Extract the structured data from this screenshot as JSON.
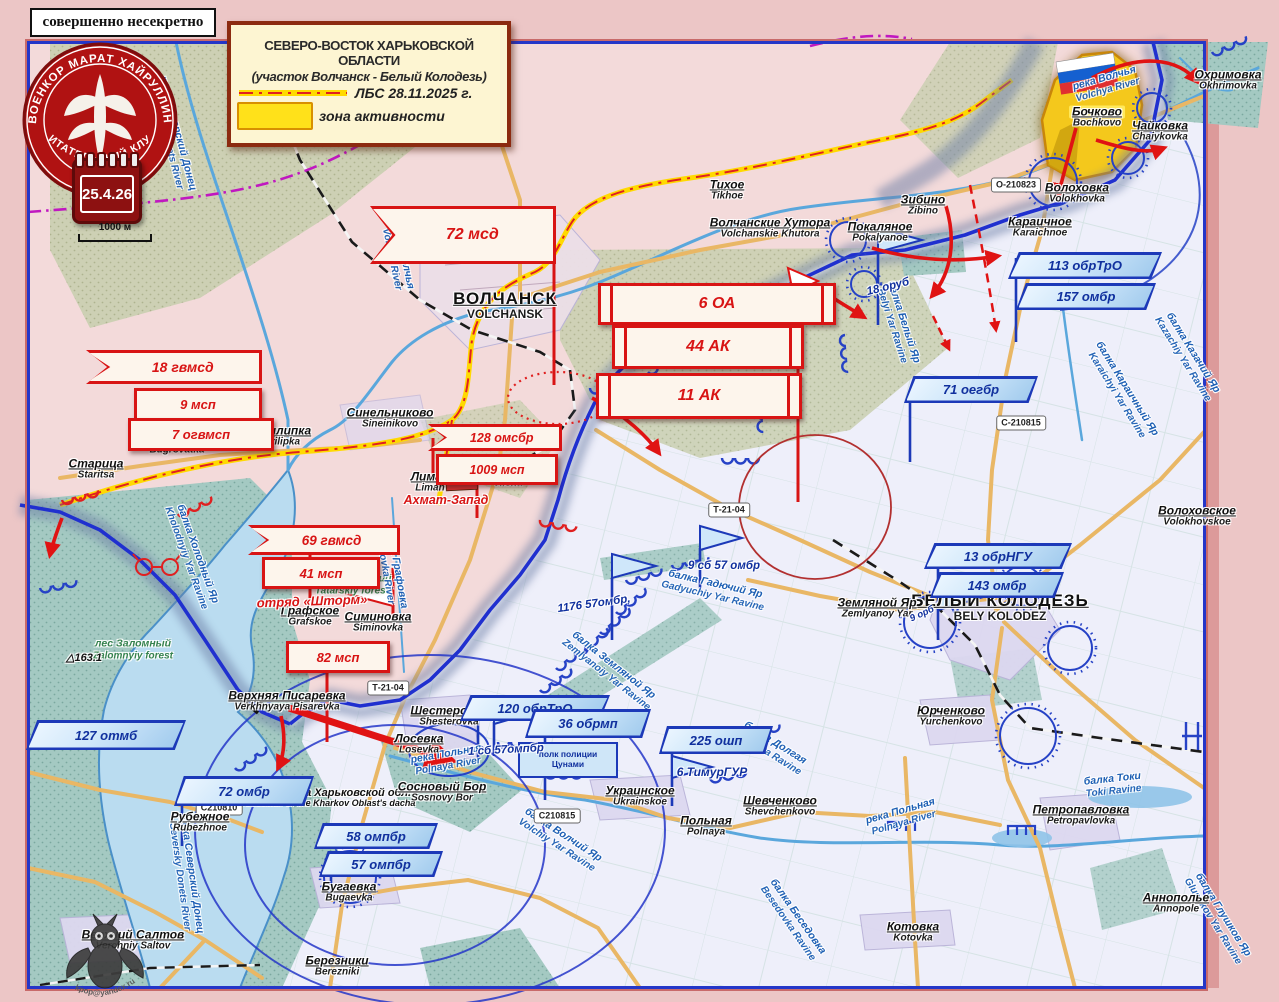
{
  "frame": {
    "stamp": "совершенно несекретно",
    "date": "25.4.26",
    "scale": "1000 м"
  },
  "logo": {
    "top": "ВОЕНКОР МАРАТ ХАЙРУЛЛИН",
    "bottom": "ЧИТАТЕЛЬСКИЙ КЛУБ"
  },
  "watermark": "kpop@yandex.ru",
  "title_box": {
    "line1": "СЕВЕРО-ВОСТОК ХАРЬКОВСКОЙ ОБЛАСТИ",
    "line2": "(участок  Волчанск - Белый Колодезь)",
    "lbs": "ЛБС  28.11.2025 г.",
    "zone": "зона активности"
  },
  "colors": {
    "red_units": "#d81414",
    "blue_units": "#1c39b8",
    "front_line": "#2030cf",
    "lbs_yellow": "#ffd900",
    "zone_yellow": "#f5c81a"
  },
  "settlements": [
    {
      "ru": "ВОЛЧАНСК",
      "en": "VOLCHANSK",
      "x": 505,
      "y": 305,
      "big": true
    },
    {
      "ru": "БЕЛЫЙ КОЛОДЕЗЬ",
      "en": "BELY KOLODEZ",
      "x": 1000,
      "y": 607,
      "big": true
    },
    {
      "ru": "Тихое",
      "en": "Tikhoe",
      "x": 727,
      "y": 190
    },
    {
      "ru": "Волчанские Хутора",
      "en": "Volchanskie Khutora",
      "x": 770,
      "y": 228
    },
    {
      "ru": "Зибино",
      "en": "Zibino",
      "x": 923,
      "y": 205
    },
    {
      "ru": "Покаляное",
      "en": "Pokalyanoe",
      "x": 880,
      "y": 232
    },
    {
      "ru": "Бочково",
      "en": "Bochkovo",
      "x": 1097,
      "y": 117,
      "hl": true
    },
    {
      "ru": "Чайковка",
      "en": "Chaiykovka",
      "x": 1160,
      "y": 131
    },
    {
      "ru": "Охримовка",
      "en": "Okhrimovka",
      "x": 1228,
      "y": 80
    },
    {
      "ru": "Волоховка",
      "en": "Volokhovka",
      "x": 1077,
      "y": 193
    },
    {
      "ru": "Караичное",
      "en": "Karaichnoe",
      "x": 1040,
      "y": 227
    },
    {
      "ru": "Волоховское",
      "en": "Volokhovskoe",
      "x": 1197,
      "y": 516
    },
    {
      "ru": "Синельниково",
      "en": "Sineinikovo",
      "x": 390,
      "y": 418
    },
    {
      "ru": "Прилипка",
      "en": "Prilipka",
      "x": 282,
      "y": 436
    },
    {
      "ru": "Бугроватка",
      "en": "Bugrovatka",
      "x": 177,
      "y": 444
    },
    {
      "ru": "Старица",
      "en": "Staritsa",
      "x": 96,
      "y": 469
    },
    {
      "ru": "Вильча",
      "en": "Vilcha",
      "x": 508,
      "y": 477
    },
    {
      "ru": "Лиман",
      "en": "Liman",
      "x": 430,
      "y": 482
    },
    {
      "ru": "Графское",
      "en": "Grafskoe",
      "x": 310,
      "y": 616
    },
    {
      "ru": "Симиновка",
      "en": "Siminovka",
      "x": 378,
      "y": 622
    },
    {
      "ru": "Верхняя Писаревка",
      "en": "Verkhnyaya  Pisarevka",
      "x": 287,
      "y": 701
    },
    {
      "ru": "Шестеровка",
      "en": "Shesterovka",
      "x": 449,
      "y": 716
    },
    {
      "ru": "Лосевка",
      "en": "Losevka",
      "x": 419,
      "y": 744
    },
    {
      "ru": "Сосновый Бор",
      "en": "Sosnovy  Bor",
      "x": 442,
      "y": 792
    },
    {
      "ru": "Рубежное",
      "en": "Rubezhnoe",
      "x": 200,
      "y": 822
    },
    {
      "ru": "Бугаевка",
      "en": "Bugaevka",
      "x": 349,
      "y": 892
    },
    {
      "ru": "Верхний Салтов",
      "en": "Verchniy  Saltov",
      "x": 133,
      "y": 940
    },
    {
      "ru": "Березники",
      "en": "Berezniki",
      "x": 337,
      "y": 966
    },
    {
      "ru": "Украинское",
      "en": "Ukrainskoe",
      "x": 640,
      "y": 796
    },
    {
      "ru": "Польная",
      "en": "Polnaya",
      "x": 706,
      "y": 826
    },
    {
      "ru": "Шевченково",
      "en": "Shevchenkovo",
      "x": 780,
      "y": 806
    },
    {
      "ru": "Земляной Яр",
      "en": "Zemlyanoy  Yar",
      "x": 877,
      "y": 608
    },
    {
      "ru": "Юрченково",
      "en": "Yurchenkovo",
      "x": 951,
      "y": 716
    },
    {
      "ru": "Петропавловка",
      "en": "Petropavlovka",
      "x": 1081,
      "y": 815
    },
    {
      "ru": "Котовка",
      "en": "Kotovka",
      "x": 913,
      "y": 932
    },
    {
      "ru": "Аннополье",
      "en": "Annopole",
      "x": 1176,
      "y": 903
    }
  ],
  "geo_labels": [
    {
      "ru": "река Северский Донец",
      "en": "Seversky Donets River",
      "x": 172,
      "y": 135,
      "rot": 75,
      "cls": "water"
    },
    {
      "ru": "река Волчья",
      "en": "Volchya River",
      "x": 1106,
      "y": 84,
      "rot": -16,
      "cls": "water"
    },
    {
      "ru": "Река Волчья",
      "en": "Volchiy River",
      "x": 398,
      "y": 258,
      "rot": 78,
      "cls": "water"
    },
    {
      "ru": "балка Белый Яр",
      "en": "Belyi Yar Ravine",
      "x": 898,
      "y": 324,
      "rot": 72,
      "cls": "water"
    },
    {
      "ru": "балка Караичный Яр",
      "en": "Karaichyi Yar Ravine",
      "x": 1122,
      "y": 392,
      "rot": 58,
      "cls": "water"
    },
    {
      "ru": "балка Казачий Яр",
      "en": "Kazachiy Yar Ravine",
      "x": 1188,
      "y": 356,
      "rot": 58,
      "cls": "water"
    },
    {
      "ru": "балка Холодный Яр",
      "en": "Kholodnyiy Yar Ravine",
      "x": 192,
      "y": 556,
      "rot": 70,
      "cls": "water"
    },
    {
      "ru": "лес Заломный",
      "en": "Zalomnyiy forest",
      "x": 133,
      "y": 650,
      "rot": 0,
      "cls": "forest"
    },
    {
      "ru": "лес Татарский",
      "en": "Tatarskiy forest",
      "x": 352,
      "y": 585,
      "rot": 0,
      "cls": "forest"
    },
    {
      "ru": "речка Графовка",
      "en": "Grafovka River",
      "x": 391,
      "y": 568,
      "rot": 80,
      "cls": "water"
    },
    {
      "ru": "балка Гадючий Яр",
      "en": "Gadyuchiy Yar Ravine",
      "x": 714,
      "y": 590,
      "rot": 13,
      "cls": "water"
    },
    {
      "ru": "балка Земляной Яр",
      "en": "Zemlyanoiy Yar Ravine",
      "x": 610,
      "y": 670,
      "rot": 38,
      "cls": "water"
    },
    {
      "ru": "балка Долгая",
      "en": "Dolgaya Ravine",
      "x": 772,
      "y": 748,
      "rot": 32,
      "cls": "water"
    },
    {
      "ru": "балка Токи",
      "en": "Toki Ravine",
      "x": 1113,
      "y": 785,
      "rot": -6,
      "cls": "water"
    },
    {
      "ru": "река Польная",
      "en": "Polnaya River",
      "x": 902,
      "y": 817,
      "rot": -16,
      "cls": "water"
    },
    {
      "ru": "река Польная",
      "en": "Polnaya River",
      "x": 447,
      "y": 760,
      "rot": -10,
      "cls": "water"
    },
    {
      "ru": "балка Волчий Яр",
      "en": "Volchiy Yar Ravine",
      "x": 560,
      "y": 840,
      "rot": 33,
      "cls": "water"
    },
    {
      "ru": "балка Беседовка",
      "en": "Besedovka Ravine",
      "x": 793,
      "y": 920,
      "rot": 55,
      "cls": "water"
    },
    {
      "ru": "балка Глушков Яр",
      "en": "Glushkov Yar Ravine",
      "x": 1218,
      "y": 918,
      "rot": 58,
      "cls": "water"
    },
    {
      "ru": "река Северский Донец",
      "en": "Seversky Donets River",
      "x": 186,
      "y": 876,
      "rot": 82,
      "cls": "water"
    },
    {
      "ru": "дача прокурора Харьковской обл.",
      "en": "the prosecutor of the Kharkov Oblast's dacha",
      "x": 318,
      "y": 798,
      "rot": 0,
      "cls": "dark"
    },
    {
      "ru": "△163.1",
      "en": "",
      "x": 84,
      "y": 658,
      "rot": 0,
      "cls": "dark"
    }
  ],
  "road_labels": [
    {
      "t": "О-210823",
      "x": 1016,
      "y": 185
    },
    {
      "t": "С-210815",
      "x": 1021,
      "y": 423
    },
    {
      "t": "Т-21-04",
      "x": 729,
      "y": 510
    },
    {
      "t": "Т-21-04",
      "x": 388,
      "y": 688
    },
    {
      "t": "С210810",
      "x": 219,
      "y": 808
    },
    {
      "t": "С210815",
      "x": 557,
      "y": 816
    }
  ],
  "red_units": [
    {
      "kind": "army",
      "label": "6 ОА",
      "x": 598,
      "y": 283,
      "w": 232,
      "h": 36,
      "fs": 16
    },
    {
      "kind": "army",
      "label": "44 АК",
      "x": 612,
      "y": 325,
      "w": 186,
      "h": 38,
      "fs": 16
    },
    {
      "kind": "army",
      "label": "11 АК",
      "x": 596,
      "y": 373,
      "w": 200,
      "h": 40,
      "fs": 16
    },
    {
      "kind": "pennant",
      "label": "18 гвмсд",
      "x": 86,
      "y": 350,
      "w": 176,
      "h": 34,
      "fs": 14
    },
    {
      "kind": "box",
      "label": "9 мсп",
      "x": 134,
      "y": 388,
      "w": 122,
      "h": 27,
      "fs": 13
    },
    {
      "kind": "box",
      "label": "7 огвмсп",
      "x": 128,
      "y": 418,
      "w": 140,
      "h": 27,
      "fs": 13
    },
    {
      "kind": "pennant",
      "label": "72 мсд",
      "x": 370,
      "y": 206,
      "w": 186,
      "h": 58,
      "fs": 16
    },
    {
      "kind": "pennant",
      "label": "128 омсбр",
      "x": 428,
      "y": 424,
      "w": 134,
      "h": 27,
      "fs": 12.5
    },
    {
      "kind": "box",
      "label": "1009 мсп",
      "x": 436,
      "y": 454,
      "w": 116,
      "h": 25,
      "fs": 12.5
    },
    {
      "kind": "pennant",
      "label": "69 гвмсд",
      "x": 248,
      "y": 525,
      "w": 152,
      "h": 30,
      "fs": 13.5
    },
    {
      "kind": "box",
      "label": "41 мсп",
      "x": 262,
      "y": 557,
      "w": 112,
      "h": 26,
      "fs": 13
    },
    {
      "kind": "text",
      "label": "отряд «Шторм»",
      "x": 312,
      "y": 601,
      "fs": 13,
      "rot": -2
    },
    {
      "kind": "box",
      "label": "82 мсп",
      "x": 286,
      "y": 641,
      "w": 98,
      "h": 26,
      "fs": 13
    },
    {
      "kind": "text",
      "label": "Ахмат-Запад",
      "x": 446,
      "y": 500,
      "fs": 12.5,
      "rot": 0
    }
  ],
  "blue_units": [
    {
      "kind": "flag",
      "label": "127 отмб",
      "x": 26,
      "y": 720,
      "w": 160,
      "h": 30
    },
    {
      "kind": "flag",
      "label": "72 омбр",
      "x": 174,
      "y": 776,
      "w": 140,
      "h": 30
    },
    {
      "kind": "flag",
      "label": "113 обрТрО",
      "x": 1008,
      "y": 252,
      "w": 154,
      "h": 27
    },
    {
      "kind": "flag",
      "label": "157 омбр",
      "x": 1016,
      "y": 283,
      "w": 140,
      "h": 27
    },
    {
      "kind": "flag",
      "label": "71 оегбр",
      "x": 904,
      "y": 376,
      "w": 134,
      "h": 27
    },
    {
      "kind": "flag",
      "label": "13 обрНГУ",
      "x": 924,
      "y": 543,
      "w": 148,
      "h": 26
    },
    {
      "kind": "flag",
      "label": "143 омбр",
      "x": 930,
      "y": 572,
      "w": 134,
      "h": 26
    },
    {
      "kind": "flag",
      "label": "120 обрТрО",
      "x": 460,
      "y": 695,
      "w": 150,
      "h": 26
    },
    {
      "kind": "flag",
      "label": "36 обрмп",
      "x": 525,
      "y": 709,
      "w": 126,
      "h": 29
    },
    {
      "kind": "box2",
      "l1": "полк полиции",
      "l2": "Цунами",
      "x": 518,
      "y": 742,
      "w": 96,
      "h": 32
    },
    {
      "kind": "flag",
      "label": "225 ошп",
      "x": 659,
      "y": 726,
      "w": 114,
      "h": 28
    },
    {
      "kind": "text",
      "label": "6 ТимурГУР",
      "x": 712,
      "y": 772,
      "fs": 12
    },
    {
      "kind": "flag",
      "label": "58 омпбр",
      "x": 314,
      "y": 823,
      "w": 124,
      "h": 26
    },
    {
      "kind": "flag",
      "label": "57 омпбр",
      "x": 319,
      "y": 851,
      "w": 124,
      "h": 26
    },
    {
      "kind": "text",
      "label": "18 оруб",
      "x": 888,
      "y": 287,
      "rot": -14,
      "fs": 11.5
    },
    {
      "kind": "text",
      "label": "1176 57омбр,",
      "x": 594,
      "y": 604,
      "rot": -8,
      "fs": 11.5
    },
    {
      "kind": "text",
      "label": "9 сб 57 омбр",
      "x": 724,
      "y": 566,
      "fs": 11.5
    },
    {
      "kind": "text",
      "label": "1 сб 57омпбр",
      "x": 506,
      "y": 750,
      "rot": -3,
      "fs": 11.5
    },
    {
      "kind": "text",
      "label": "9 орб",
      "x": 922,
      "y": 614,
      "rot": -25,
      "fs": 9.5
    }
  ],
  "misc": {
    "elevation": "163.1"
  }
}
